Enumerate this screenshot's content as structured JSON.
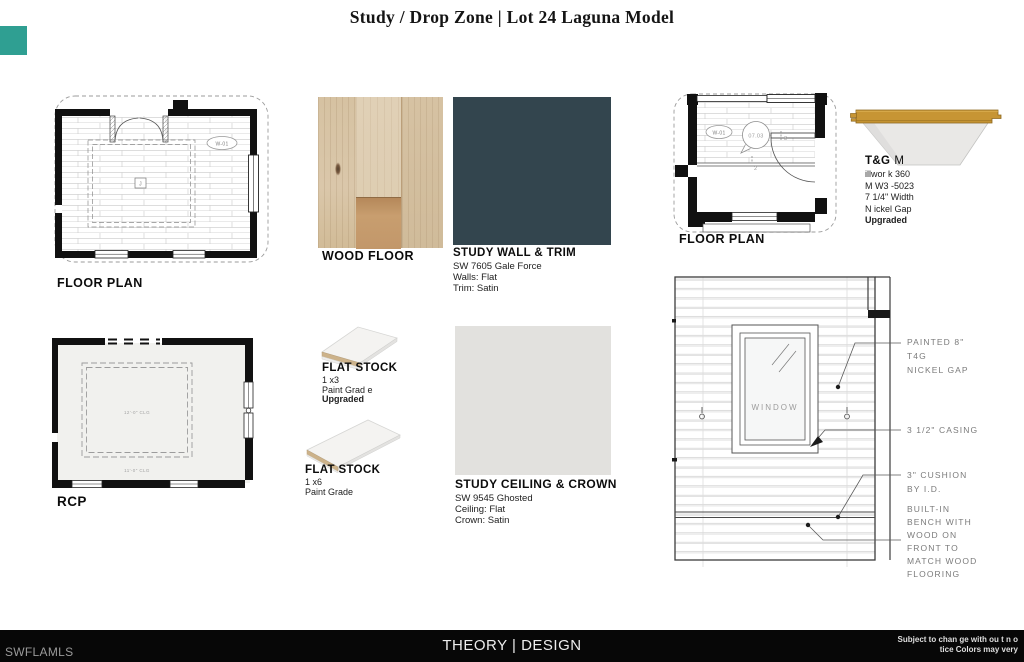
{
  "title": "Study / Drop Zone | Lot 24 Laguna Model",
  "watermark": {
    "logo_color": "#2f9f92",
    "label": "SWFLAMLS"
  },
  "study_plan": {
    "caption": "FLOOR PLAN",
    "window_tag": "W-01",
    "junction_tag": "J"
  },
  "wood_floor": {
    "caption": "WOOD FLOOR"
  },
  "study_wall": {
    "caption": "STUDY WALL & TRIM",
    "spec1": "SW 7605 Gale Force",
    "spec2": "Walls: Flat",
    "spec3": "Trim: Satin",
    "color": "#33454e"
  },
  "drop_plan": {
    "caption": "FLOOR PLAN",
    "window_tag": "W-01",
    "door_tag": "07.03",
    "leaf_tag_a": "3",
    "leaf_tag_b": "2"
  },
  "tongue_groove": {
    "title_bold": "T&G",
    "title_tail": "M",
    "spec1": "illwor k 360",
    "spec2": "M W3 -5023",
    "spec3": "7 1/4\" Width",
    "spec4": "N ickel Gap",
    "spec5": "Upgraded"
  },
  "rcp": {
    "caption": "RCP",
    "inner_clg": "12'-0\" CLG",
    "outer_clg": "11'-0\" CLG"
  },
  "flat_stock_1x3": {
    "caption": "FLAT STOCK",
    "spec1": "1 x3",
    "spec2": "Paint Grad e",
    "spec3": "Upgraded"
  },
  "flat_stock_1x6": {
    "caption": "FLAT STOCK",
    "spec1": "1 x6",
    "spec2": "Paint Grade"
  },
  "study_ceiling": {
    "caption": "STUDY CEILING & CROWN",
    "spec1": "SW 9545 Ghosted",
    "spec2": "Ceiling: Flat",
    "spec3": "Crown: Satin",
    "color": "#e2e1de"
  },
  "elevation": {
    "window_label": "WINDOW",
    "note_paneling_1": "PAINTED 8\"",
    "note_paneling_2": "T4G",
    "note_paneling_3": "NICKEL GAP",
    "note_casing": "3 1/2\" CASING",
    "note_cushion_1": "3\" CUSHION",
    "note_cushion_2": "BY I.D.",
    "note_bench_1": "BUILT-IN",
    "note_bench_2": "BENCH WITH",
    "note_bench_3": "WOOD ON",
    "note_bench_4": "FRONT TO",
    "note_bench_5": "MATCH WOOD",
    "note_bench_6": "FLOORING"
  },
  "footer": {
    "brand": "THEORY | DESIGN",
    "disclaimer_1": "Subject to chan ge with ou t n o",
    "disclaimer_2": "tice Colors may very"
  }
}
